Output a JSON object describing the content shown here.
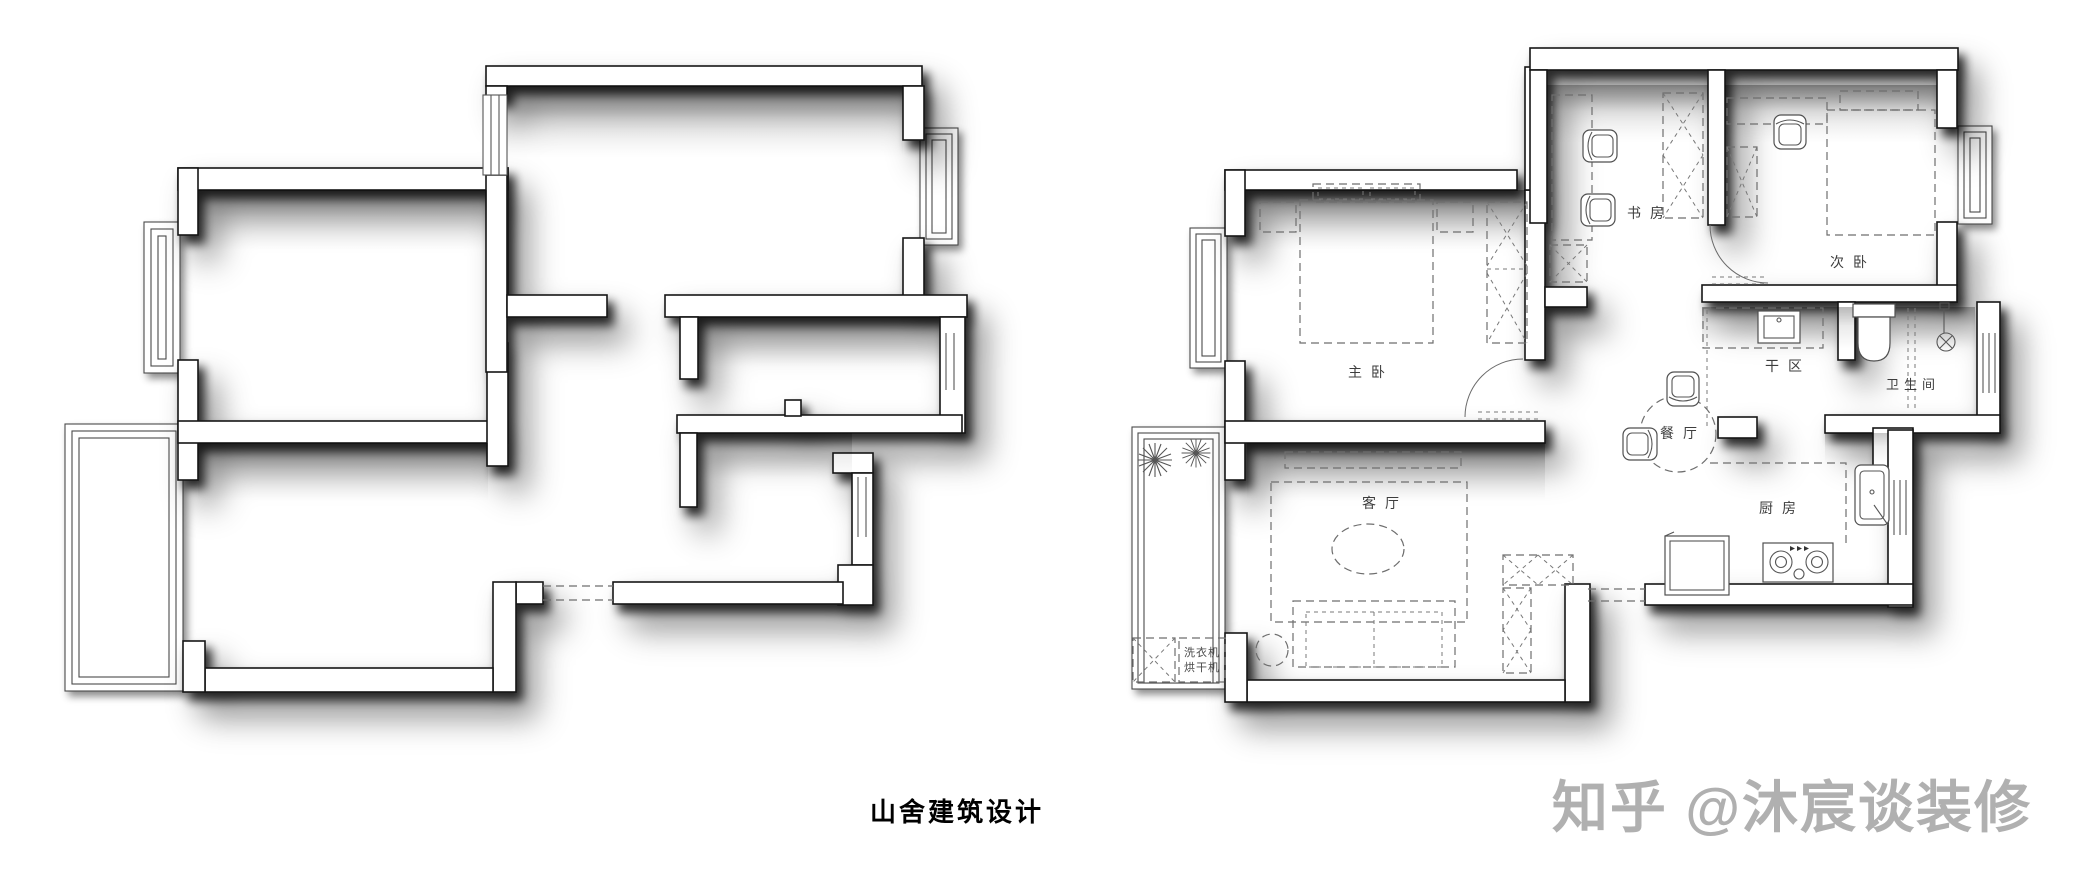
{
  "caption": "山舍建筑设计",
  "watermark": {
    "text": "知乎 @沐宸谈装修",
    "color": "#b0b0b0"
  },
  "rooms": {
    "study": "书房",
    "secondary_bedroom": "次卧",
    "master_bedroom": "主卧",
    "dry_area": "干区",
    "bathroom": "卫生间",
    "dining": "餐厅",
    "kitchen": "厨房",
    "living": "客厅",
    "washing_machine": "洗衣机",
    "dryer": "烘干机"
  },
  "colors": {
    "background": "#ffffff",
    "wall_fill": "#ffffff",
    "wall_outline": "#161616",
    "furniture_line": "#6e6e6e",
    "label_text": "#3d3d3d",
    "caption_text": "#000000",
    "watermark_text": "#b0b0b0"
  }
}
